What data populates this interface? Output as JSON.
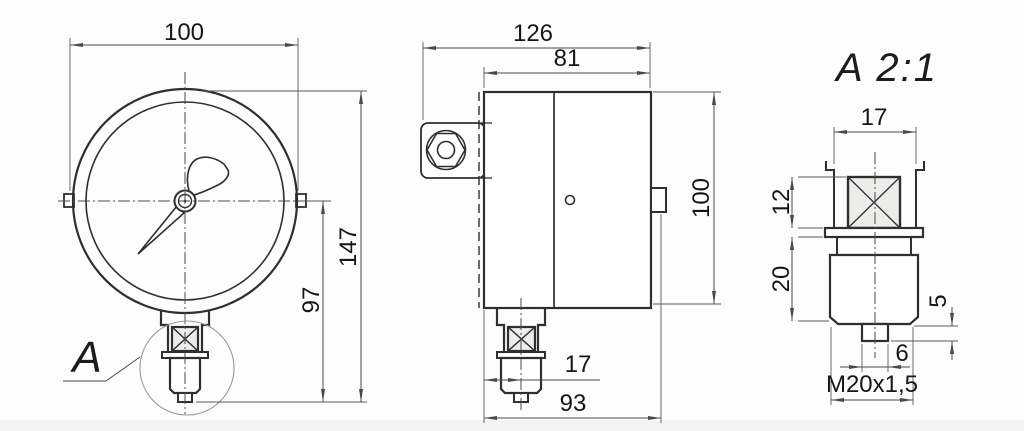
{
  "front_view": {
    "label_letter": "A",
    "dims": {
      "width": "100",
      "total_height": "147",
      "lower_height": "97"
    }
  },
  "side_view": {
    "dims": {
      "total_width": "126",
      "body_width": "81",
      "body_height": "100",
      "axis_offset": "17",
      "total_depth": "93"
    }
  },
  "detail_view": {
    "title": "A 2:1",
    "dims": {
      "holder_width": "17",
      "square_height": "12",
      "boss_height": "20",
      "tip_height": "5",
      "tip_width": "6",
      "thread": "M20x1,5"
    }
  },
  "colors": {
    "line": "#2f2f2f",
    "dim_line": "#4a4a4a",
    "square_fill": "#ececeb",
    "background": "#fdfdfd"
  }
}
